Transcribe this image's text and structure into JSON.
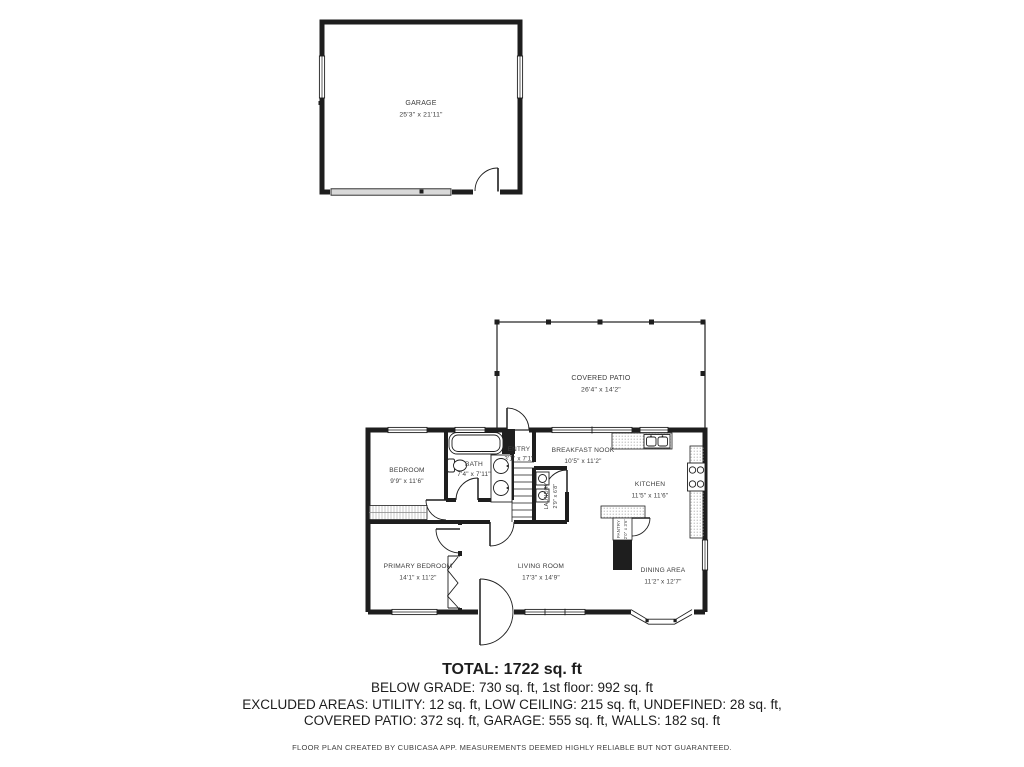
{
  "floor_plan": {
    "garage": {
      "label": "GARAGE",
      "dims": "25'3\" x 21'11\""
    },
    "covered_patio": {
      "label": "COVERED PATIO",
      "dims": "26'4\" x 14'2\""
    },
    "bedroom": {
      "label": "BEDROOM",
      "dims": "9'9\" x 11'6\""
    },
    "bath": {
      "label": "BATH",
      "dims": "7'4\" x 7'11\""
    },
    "entry": {
      "label": "ENTRY",
      "dims": "3'1\" x 7'1\""
    },
    "breakfast_nook": {
      "label": "BREAKFAST NOOK",
      "dims": "10'5\" x 11'2\""
    },
    "kitchen": {
      "label": "KITCHEN",
      "dims": "11'5\" x 11'6\""
    },
    "laundry": {
      "label": "LAUNDRY",
      "dims": "2'9\" x 6'8\""
    },
    "pantry": {
      "label": "PANTRY",
      "dims": "2'0\" x 3'6\""
    },
    "living_room": {
      "label": "LIVING ROOM",
      "dims": "17'3\" x 14'9\""
    },
    "primary_bedroom": {
      "label": "PRIMARY BEDROOM",
      "dims": "14'1\" x 11'2\""
    },
    "dining_area": {
      "label": "DINING AREA",
      "dims": "11'2\" x 12'7\""
    }
  },
  "summary": {
    "total": "TOTAL: 1722 sq. ft",
    "floors": "BELOW GRADE: 730 sq. ft, 1st floor: 992 sq. ft",
    "excluded_1": "EXCLUDED AREAS: UTILITY: 12 sq. ft, LOW CEILING: 215 sq. ft, UNDEFINED: 28 sq. ft,",
    "excluded_2": "COVERED PATIO: 372 sq. ft, GARAGE: 555 sq. ft, WALLS: 182 sq. ft",
    "disclaimer": "FLOOR PLAN CREATED BY CUBICASA APP. MEASUREMENTS DEEMED HIGHLY RELIABLE BUT NOT GUARANTEED."
  },
  "colors": {
    "wall": "#1e1e1e",
    "label": "#3c3c3c"
  }
}
